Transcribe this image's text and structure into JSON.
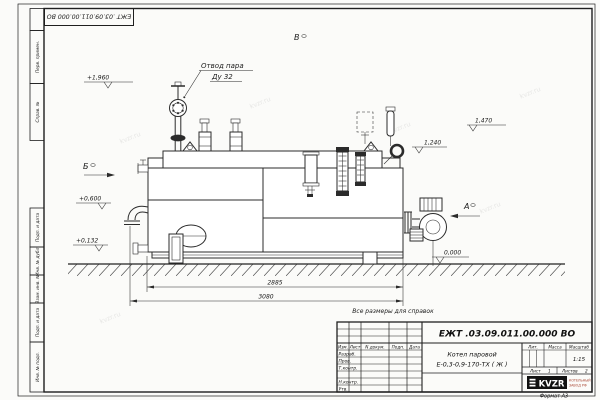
{
  "sheet": {
    "doc_number_stamp": "ЕЖТ .03.09.011.00.000  ВО",
    "format_note": "Формат А3",
    "side_strip_upper": [
      "Перв. примен.",
      "Справ. №"
    ],
    "side_strip_lower": [
      "Подп. и дата",
      "Инв. № дубл.",
      "Взам. инв. №",
      "Подп. и дата",
      "Инв. № подл."
    ],
    "watermark": "kvzr.ru"
  },
  "drawing": {
    "reference_note": "Все размеры для справок",
    "callout_line1": "Отвод пара",
    "callout_line2": "Ду 32",
    "view_left": "Б",
    "view_top": "В",
    "view_right": "А",
    "elev_steam_valve": "+1,960",
    "elev_gauge": "1,470",
    "elev_drum": "1,240",
    "elev_feed": "+0,600",
    "elev_drain": "+0,132",
    "elev_ground": "0,000",
    "dim_inner": "2885",
    "dim_overall": "3080"
  },
  "title_block": {
    "doc_number": "ЕЖТ .03.09.011.00.000  ВО",
    "product_line1": "Котел паровой",
    "product_line2": "Е-0,3-0,9-170-ТХ ( Ж )",
    "col_izm": "Изм.",
    "col_list": "Лист",
    "col_doc": "N докум.",
    "col_sign": "Подп.",
    "col_date": "Дата",
    "row_developed": "Разраб.",
    "row_checked": "Пров.",
    "row_tcontrol": "Т.контр.",
    "row_ncontrol": "Н.контр.",
    "row_approved": "Утв.",
    "lit_label": "Лит.",
    "mass_label": "Масса",
    "scale_label": "Масштаб",
    "scale_value": "1:15",
    "sheet_label": "Лист",
    "sheet_number": "1",
    "sheets_label": "Листов",
    "sheets_total": "2",
    "logo_text": "KVZR",
    "logo_caption_1": "КОТЕЛЬНЫЙ",
    "logo_caption_2": "ЗАВОД РФ"
  }
}
